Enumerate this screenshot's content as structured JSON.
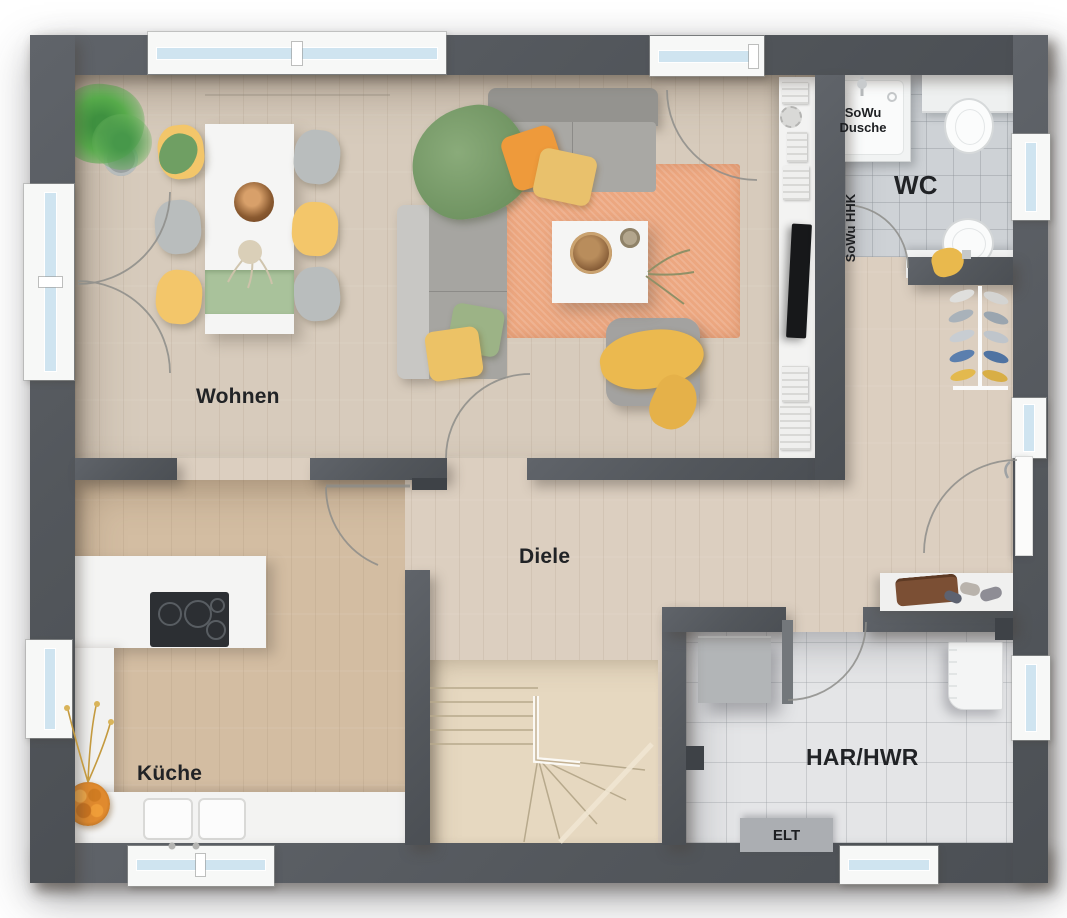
{
  "plan": {
    "type": "floor-plan",
    "floor_name": "Erdgeschoss",
    "rooms": {
      "wohnen": {
        "label": "Wohnen"
      },
      "kueche": {
        "label": "Küche"
      },
      "diele": {
        "label": "Diele"
      },
      "wc": {
        "label": "WC"
      },
      "har_hwr": {
        "label": "HAR/HWR"
      }
    },
    "annotations": {
      "elt": {
        "label": "ELT"
      },
      "shower": {
        "label": "SoWu Dusche"
      },
      "towel_radiator": {
        "label": "SoWu HHK"
      }
    },
    "colors": {
      "wall": "#54585c",
      "floor_wood_living": "#d7cbbc",
      "floor_wood_hall": "#dccfc0",
      "floor_wood_kitchen": "#d3bda2",
      "floor_tile_wc": "#ced2d6",
      "floor_tile_har": "#e4e5e7",
      "stairs_wood": "#e6d8c0",
      "rug": "#eca780",
      "sofa_grey": "#a5a4a1",
      "accent_yellow": "#edc267",
      "accent_orange": "#ee9a3b",
      "accent_green": "#7e9f6e",
      "window_glass": "#cfe4f0",
      "background": "#ffffff"
    }
  }
}
